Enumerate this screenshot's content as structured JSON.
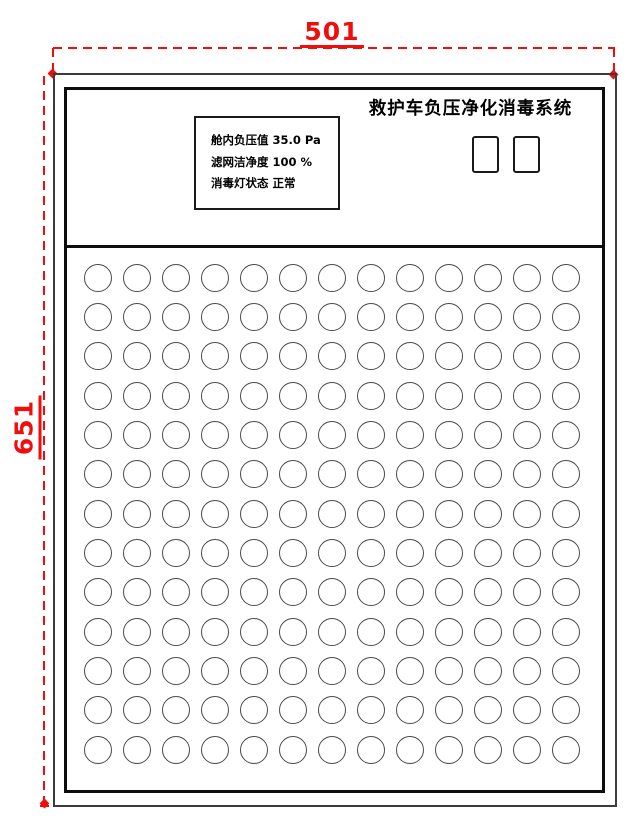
{
  "colors": {
    "dimension_red": "#f20d0d",
    "line_dark": "#1a1a1a",
    "line_mid": "#3c3c3c",
    "circle_stroke": "#4a4a4a"
  },
  "dimensions": {
    "top_width": "501",
    "left_height": "651"
  },
  "panel": {
    "title": "救护车负压净化消毒系统",
    "status_display": {
      "lines": [
        "舱内负压值 35.0 Pa",
        "滤网洁净度 100 %",
        "消毒灯状态 正常"
      ]
    },
    "buttons": {
      "count": 2
    },
    "vent_grid": {
      "rows": 13,
      "columns": 13,
      "hole_shape": "circle"
    }
  }
}
